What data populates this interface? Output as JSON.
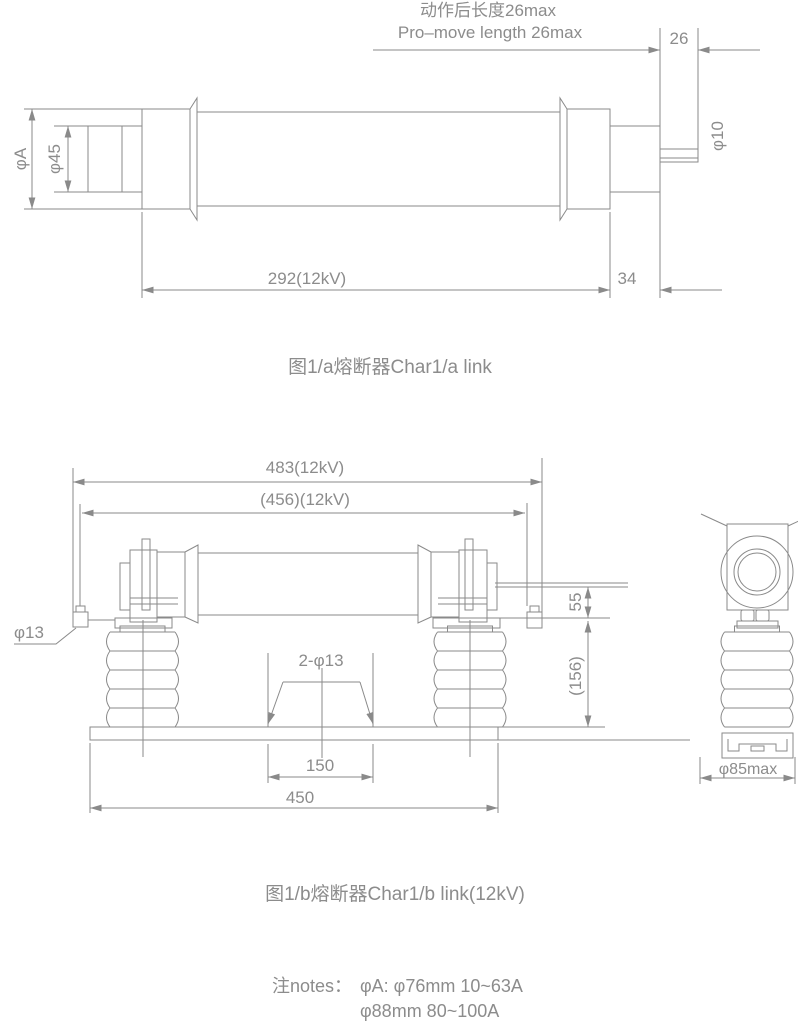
{
  "colors": {
    "line": "#8a8a8a",
    "text": "#8c8c8c",
    "background": "#ffffff"
  },
  "fig_a": {
    "caption": "图1/a熔断器Char1/a link",
    "dims": {
      "action_length_cn": "动作后长度26max",
      "action_length_en": "Pro–move length 26max",
      "striker_protrusion": "26",
      "striker_dia": "φ10",
      "body_dia": "φA",
      "contact_dia": "φ45",
      "body_length": "292(12kV)",
      "end_cap_length": "34"
    }
  },
  "fig_b": {
    "caption": "图1/b熔断器Char1/b link(12kV)",
    "dims": {
      "overall_length": "483(12kV)",
      "contact_span": "(456)(12kV)",
      "terminal_hole_dia": "φ13",
      "mounting_holes": "2-φ13",
      "contact_height": "55",
      "insulator_height": "(156)",
      "hole_spacing": "150",
      "base_length": "450",
      "insulator_dia": "φ85max"
    }
  },
  "notes": {
    "label": "注notes：",
    "line1": "φA: φ76mm 10~63A",
    "line2": "φ88mm 80~100A"
  }
}
